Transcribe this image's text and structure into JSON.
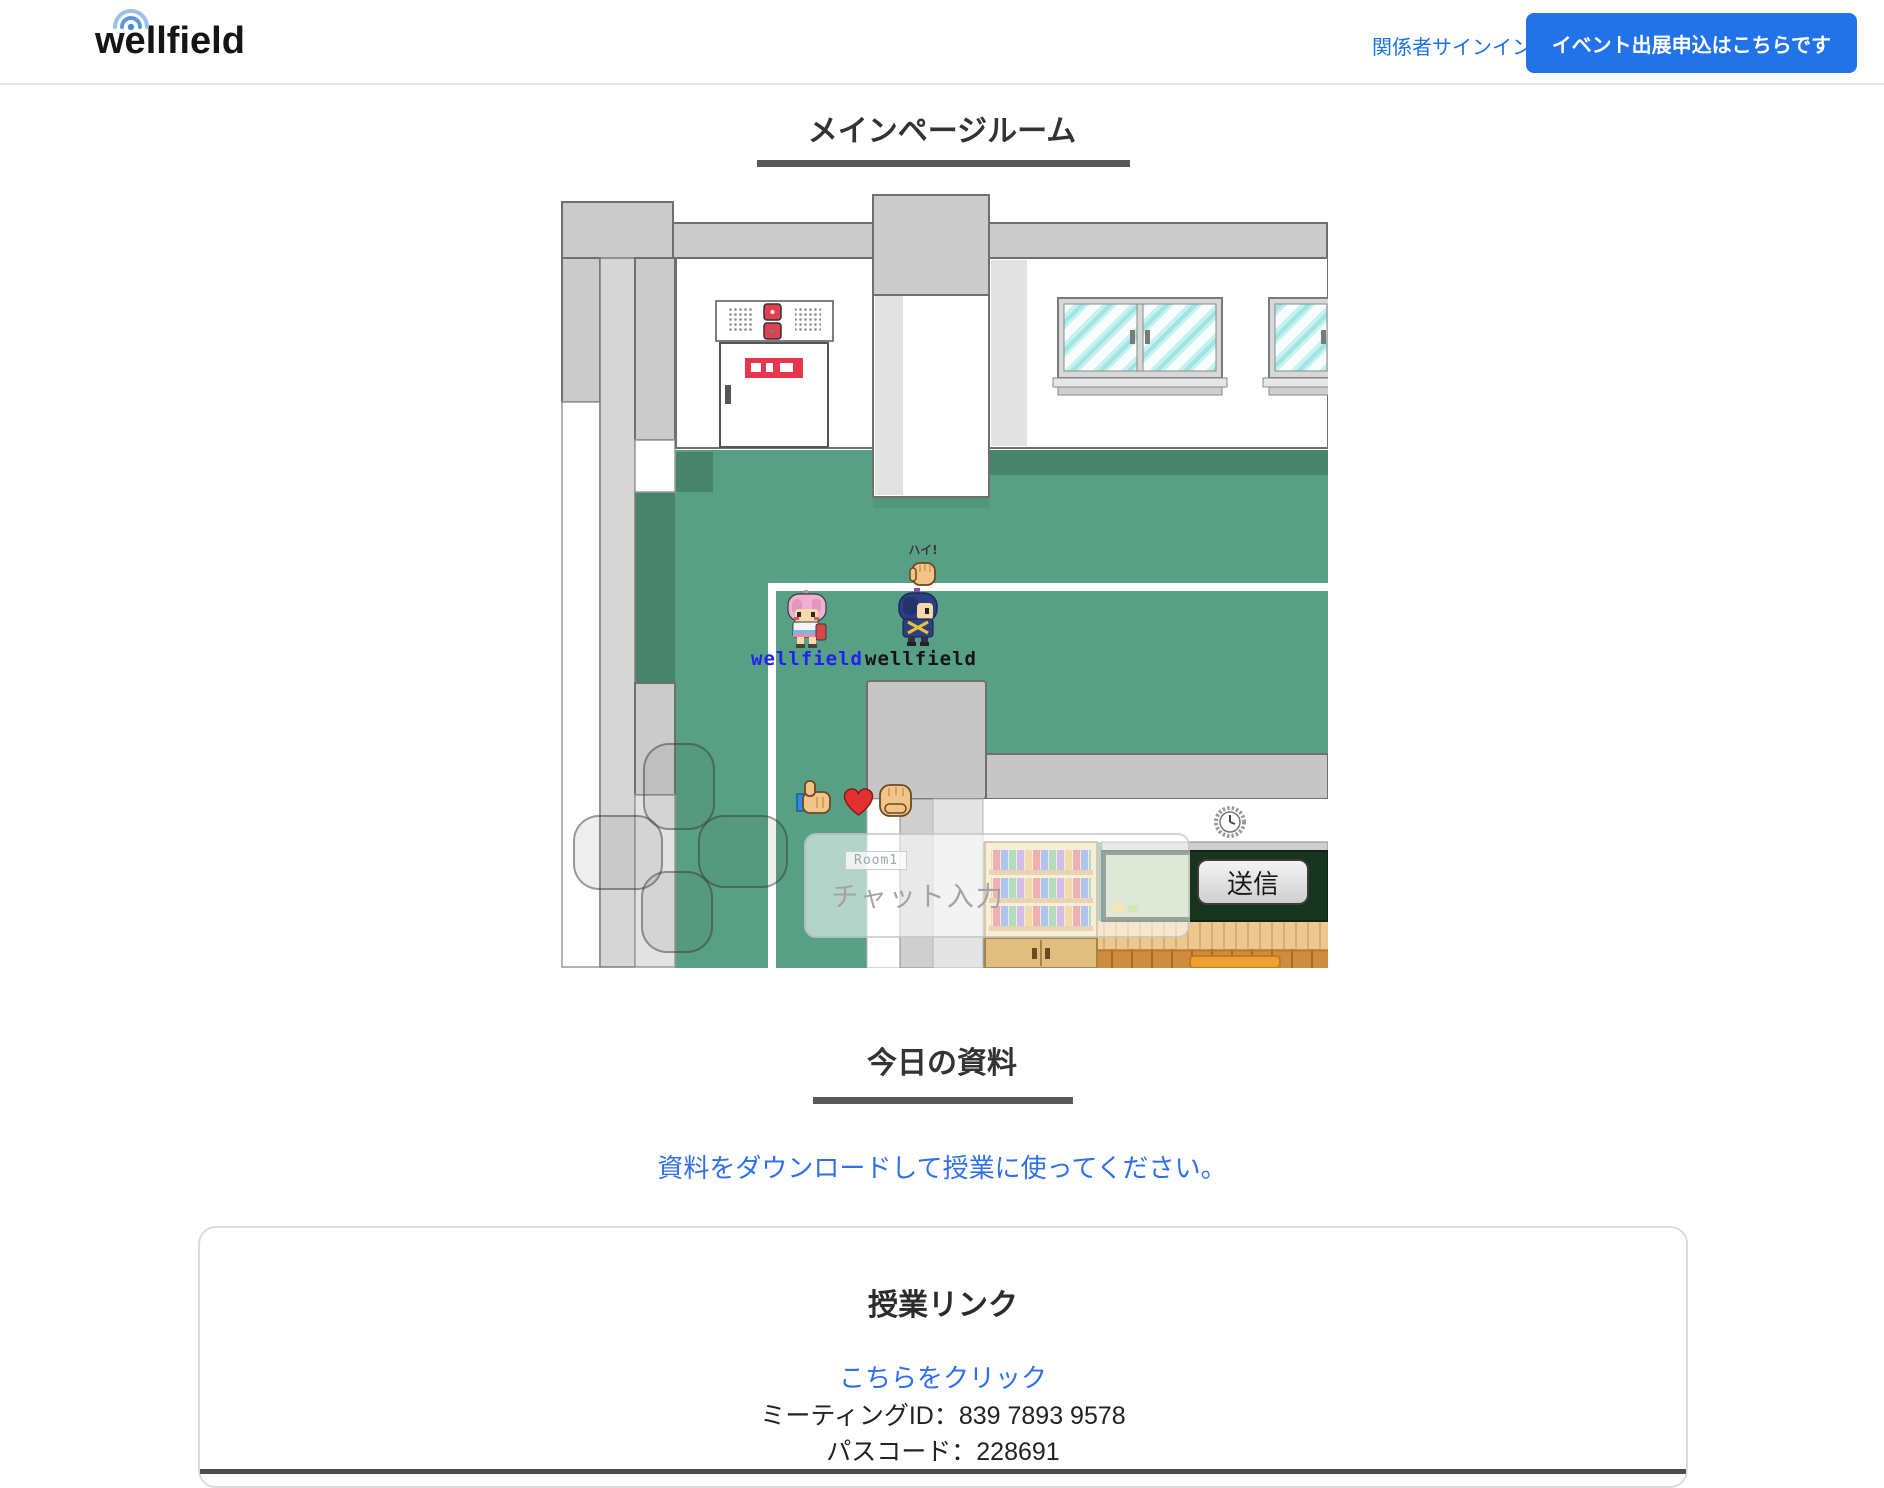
{
  "header": {
    "logo_text": "wellfield",
    "signin_link": "関係者サインイン",
    "cta_button": "イベント出展申込はこちらです"
  },
  "room_section": {
    "title": "メインページルーム"
  },
  "game": {
    "player1_label": "wellfield",
    "player2_label": "wellfield",
    "emote_bubble_text": "ハイ!",
    "chat": {
      "room_badge": "Room1",
      "placeholder": "チャット入力",
      "send_label": "送信"
    }
  },
  "materials_section": {
    "title": "今日の資料",
    "download_link": "資料をダウンロードして授業に使ってください。"
  },
  "class_link_card": {
    "title": "授業リンク",
    "click_link": "こちらをクリック",
    "meeting_id_label": "ミーティングID：",
    "meeting_id": "839 7893 9578",
    "passcode_label": "パスコード：",
    "passcode": "228691"
  },
  "colors": {
    "accent_blue": "#2272e8",
    "link_blue": "#2f6fed",
    "floor_green": "#57a085",
    "floor_green_dark": "#48836b",
    "underline_gray": "#58595b"
  }
}
